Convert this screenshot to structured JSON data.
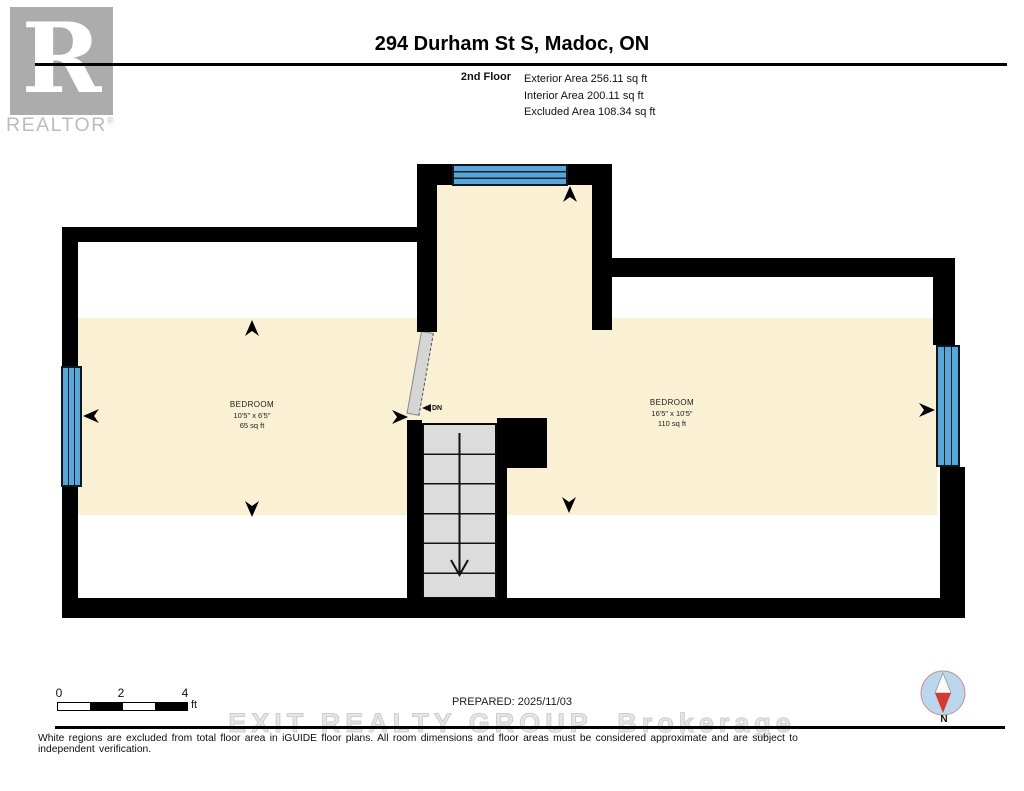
{
  "header": {
    "logo": {
      "letter": "R",
      "label": "REALTOR",
      "registered": "®"
    },
    "title": "294 Durham St S, Madoc, ON",
    "floor": {
      "name": "2nd Floor",
      "stats": [
        "Exterior Area 256.11 sq ft",
        "Interior Area 200.11 sq ft",
        "Excluded Area 108.34 sq ft"
      ]
    }
  },
  "plan": {
    "rooms": [
      {
        "name": "BEDROOM",
        "dims": "10'5\" x 6'5\"",
        "area": "65 sq ft"
      },
      {
        "name": "BEDROOM",
        "dims": "16'5\" x 10'5\"",
        "area": "110 sq ft"
      }
    ],
    "stair_label": "DN"
  },
  "footer": {
    "scale": {
      "ticks": [
        "0",
        "2",
        "4"
      ],
      "unit": "ft"
    },
    "prepared": "PREPARED: 2025/11/03",
    "watermark": "EXIT REALTY GROUP  Brokerage",
    "compass_label": "N",
    "disclaimer": "White regions are excluded from total floor area in iGUIDE floor plans. All room dimensions and floor areas must be considered approximate and are subject to independent verification."
  },
  "colors": {
    "wall": "#000000",
    "area": "#FAF1D5",
    "windowFill": "#58A7D8",
    "windowLine": "#16212b",
    "stairFill": "#DCDCDC",
    "doorFill": "#D5D5D5",
    "logoGray": "#ACACAC",
    "compassBlue": "#BBD7EE",
    "compassRed": "#D63A2F"
  }
}
